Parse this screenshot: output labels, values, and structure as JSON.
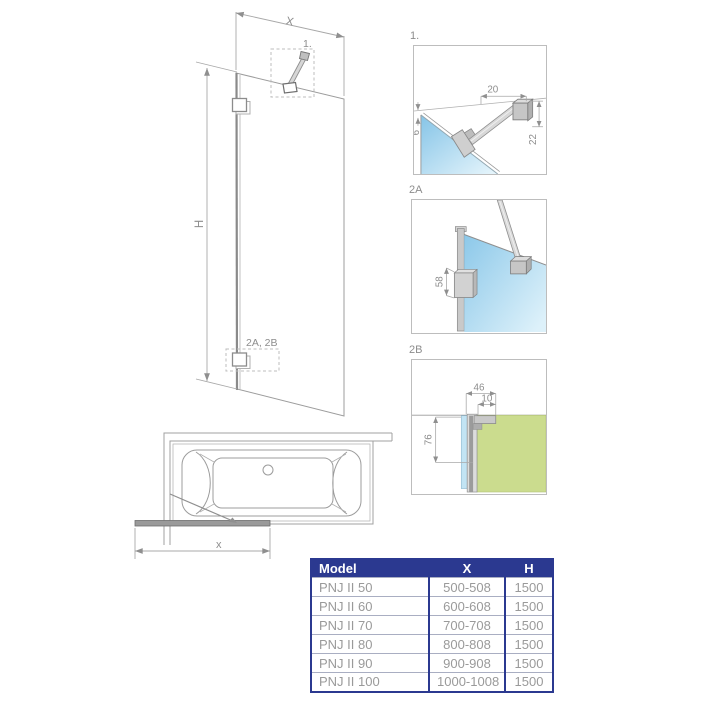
{
  "diagram": {
    "elevation": {
      "dim_width": "X",
      "dim_height": "H",
      "callout_top": "1.",
      "callout_bottom": "2A, 2B"
    },
    "plan": {
      "dim_width": "x"
    },
    "details": {
      "d1": {
        "label": "1.",
        "dim_arm_offset": "20",
        "dim_drop": "22",
        "dim_glass_gap": "6"
      },
      "d2a": {
        "label": "2A",
        "dim_bracket_height": "58"
      },
      "d2b": {
        "label": "2B",
        "dim_profile_width": "46",
        "dim_inner_width": "10",
        "dim_profile_height": "76"
      }
    },
    "colors": {
      "glass": "#8cc8e9",
      "glass_light": "#e3f4fb",
      "wall_green": "#cbdc8e",
      "line_gray": "#9b9b9b",
      "accent_navy": "#2b3990"
    }
  },
  "table": {
    "columns": [
      "Model",
      "X",
      "H"
    ],
    "rows": [
      {
        "model": "PNJ II 50",
        "x": "500-508",
        "h": "1500"
      },
      {
        "model": "PNJ II 60",
        "x": "600-608",
        "h": "1500"
      },
      {
        "model": "PNJ II 70",
        "x": "700-708",
        "h": "1500"
      },
      {
        "model": "PNJ II 80",
        "x": "800-808",
        "h": "1500"
      },
      {
        "model": "PNJ II 90",
        "x": "900-908",
        "h": "1500"
      },
      {
        "model": "PNJ II 100",
        "x": "1000-1008",
        "h": "1500"
      }
    ]
  }
}
